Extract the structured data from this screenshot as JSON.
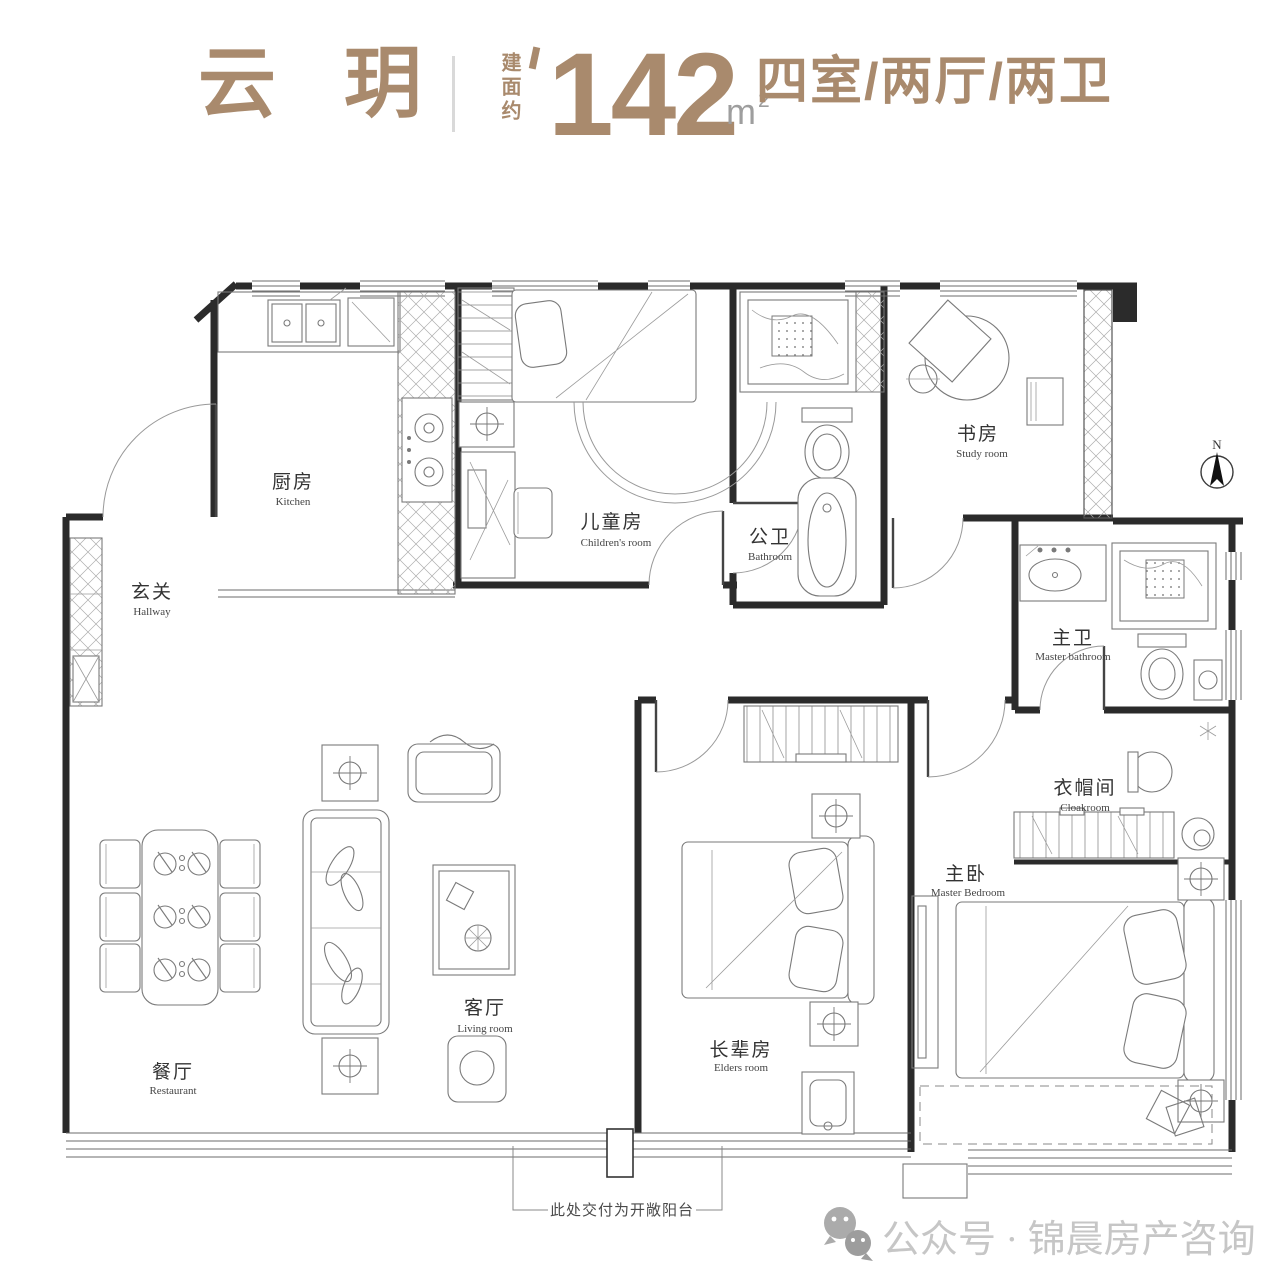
{
  "header": {
    "brand": "云玥",
    "area_label": "建面约",
    "area_value": "142",
    "area_unit": "m",
    "area_sup": "2",
    "layout_spec": "四室/两厅/两卫"
  },
  "rooms": {
    "kitchen": {
      "zh": "厨房",
      "en": "Kitchen"
    },
    "hallway": {
      "zh": "玄关",
      "en": "Hallway"
    },
    "children": {
      "zh": "儿童房",
      "en": "Children's room"
    },
    "bathroom": {
      "zh": "公卫",
      "en": "Bathroom"
    },
    "study": {
      "zh": "书房",
      "en": "Study room"
    },
    "master_bath": {
      "zh": "主卫",
      "en": "Master bathroom"
    },
    "cloakroom": {
      "zh": "衣帽间",
      "en": "Cloakroom"
    },
    "master_bedroom": {
      "zh": "主卧",
      "en": "Master Bedroom"
    },
    "elders": {
      "zh": "长辈房",
      "en": "Elders room"
    },
    "living": {
      "zh": "客厅",
      "en": "Living room"
    },
    "dining": {
      "zh": "餐厅",
      "en": "Restaurant"
    }
  },
  "annotation": {
    "balcony_note": "此处交付为开敞阳台"
  },
  "compass": {
    "north_label": "N"
  },
  "watermark": {
    "account_text": "公众号 · 锦晨房产咨询"
  },
  "colors": {
    "accent": "#a98a6d",
    "unit_gray": "#9e9e9e",
    "watermark_gray": "#c6c6c6"
  }
}
